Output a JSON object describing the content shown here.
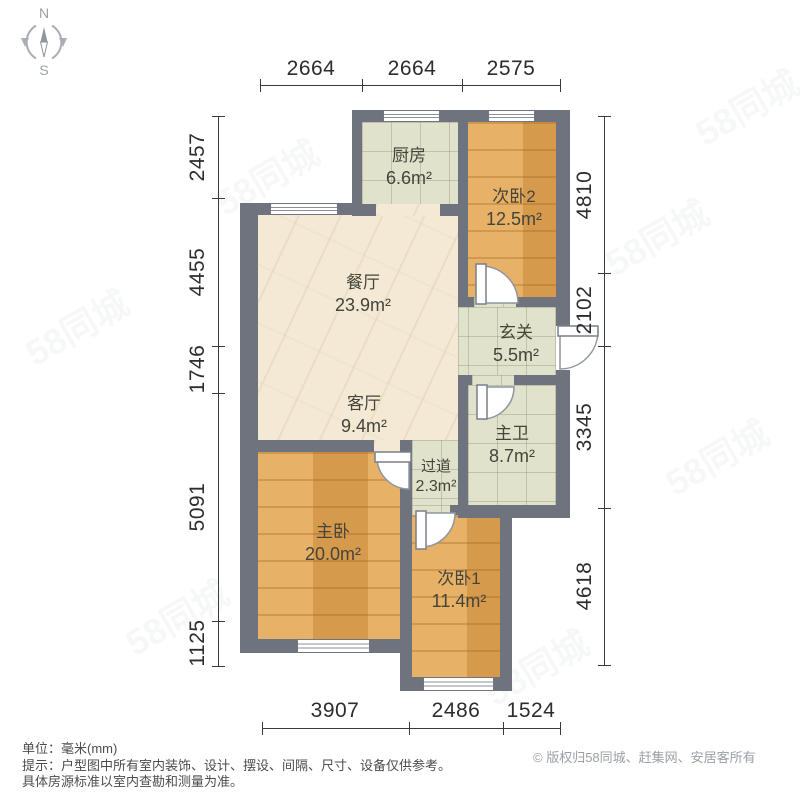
{
  "compass": {
    "north": "N",
    "south": "S"
  },
  "dims": {
    "top": [
      "2664",
      "2664",
      "2575"
    ],
    "left": [
      "2457",
      "4455",
      "1746",
      "5091",
      "1125"
    ],
    "right": [
      "4810",
      "2102",
      "3345",
      "4618"
    ],
    "bottom": [
      "3907",
      "2486",
      "1524"
    ]
  },
  "rooms": {
    "kitchen": {
      "name": "厨房",
      "area": "6.6m²"
    },
    "bedroom2": {
      "name": "次卧2",
      "area": "12.5m²"
    },
    "dining": {
      "name": "餐厅",
      "area": "23.9m²"
    },
    "entry": {
      "name": "玄关",
      "area": "5.5m²"
    },
    "living": {
      "name": "客厅",
      "area": "9.4m²"
    },
    "master_bath": {
      "name": "主卫",
      "area": "8.7m²"
    },
    "hallway": {
      "name": "过道",
      "area": "2.3m²"
    },
    "master_bedroom": {
      "name": "主卧",
      "area": "20.0m²"
    },
    "bedroom1": {
      "name": "次卧1",
      "area": "11.4m²"
    }
  },
  "footer": {
    "unit": "单位：毫米(mm)",
    "tip_line1": "提示：户型图中所有室内装饰、设计、摆设、间隔、尺寸、设备仅供参考。",
    "tip_line2": "具体房源标准以室内查勘和测量为准。",
    "copyright": "© 版权归58同城、赶集网、安居客所有"
  },
  "watermark": {
    "text": "58同城"
  },
  "colors": {
    "wall": "#6e737d",
    "wood_floor": "#e0a251",
    "tile_floor": "#e1e2cb",
    "marble_floor": "#f3e9d5"
  }
}
